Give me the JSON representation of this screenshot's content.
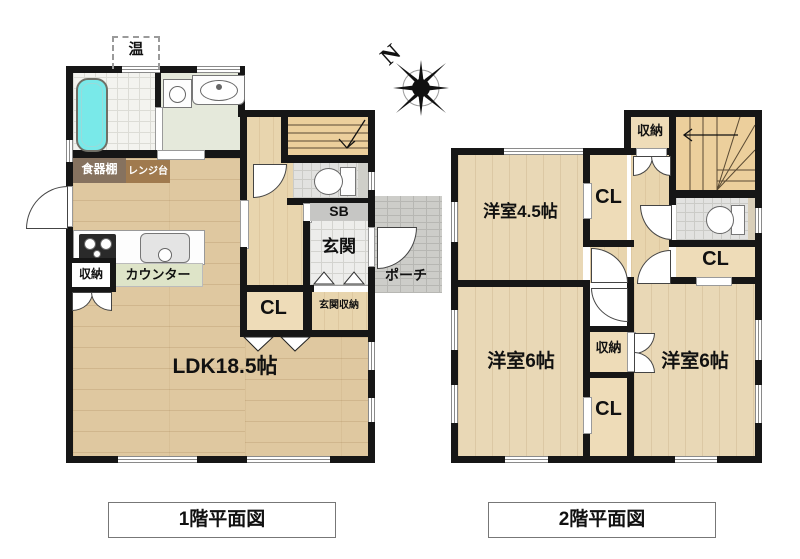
{
  "floor1": {
    "caption": "1階平面図",
    "labels": {
      "ldk": "LDK18.5帖",
      "genkan": "玄関",
      "sb": "SB",
      "cl": "CL",
      "genkan_shuno": "玄関収納",
      "porch": "ポーチ",
      "shokkidana": "食器棚",
      "renjidai": "レンジ台",
      "counter": "カウンター",
      "shuno": "収納",
      "water_heater": "温"
    }
  },
  "floor2": {
    "caption": "2階平面図",
    "labels": {
      "yoshitsu45": "洋室4.5帖",
      "yoshitsu6_left": "洋室6帖",
      "yoshitsu6_right": "洋室6帖",
      "cl_top": "CL",
      "cl_right": "CL",
      "cl_bottom": "CL",
      "shuno_top": "収納",
      "shuno_mid": "収納"
    }
  },
  "compass": {
    "north_label": "N"
  },
  "colors": {
    "wall": "#161616",
    "ldk_floor": "#dfc8a0",
    "room_floor_2f": "#e9d8b6",
    "hall_floor": "#e8d5ae",
    "stair": "#eccf9c",
    "bathtub": "#79e9e9",
    "washroom": "#e5e9db",
    "tile": "#f3f3ef",
    "porch": "#cdcdc9",
    "shelf_dark": "#86725f",
    "range_stand": "#a07a4e",
    "counter_band": "#dee4c8"
  }
}
